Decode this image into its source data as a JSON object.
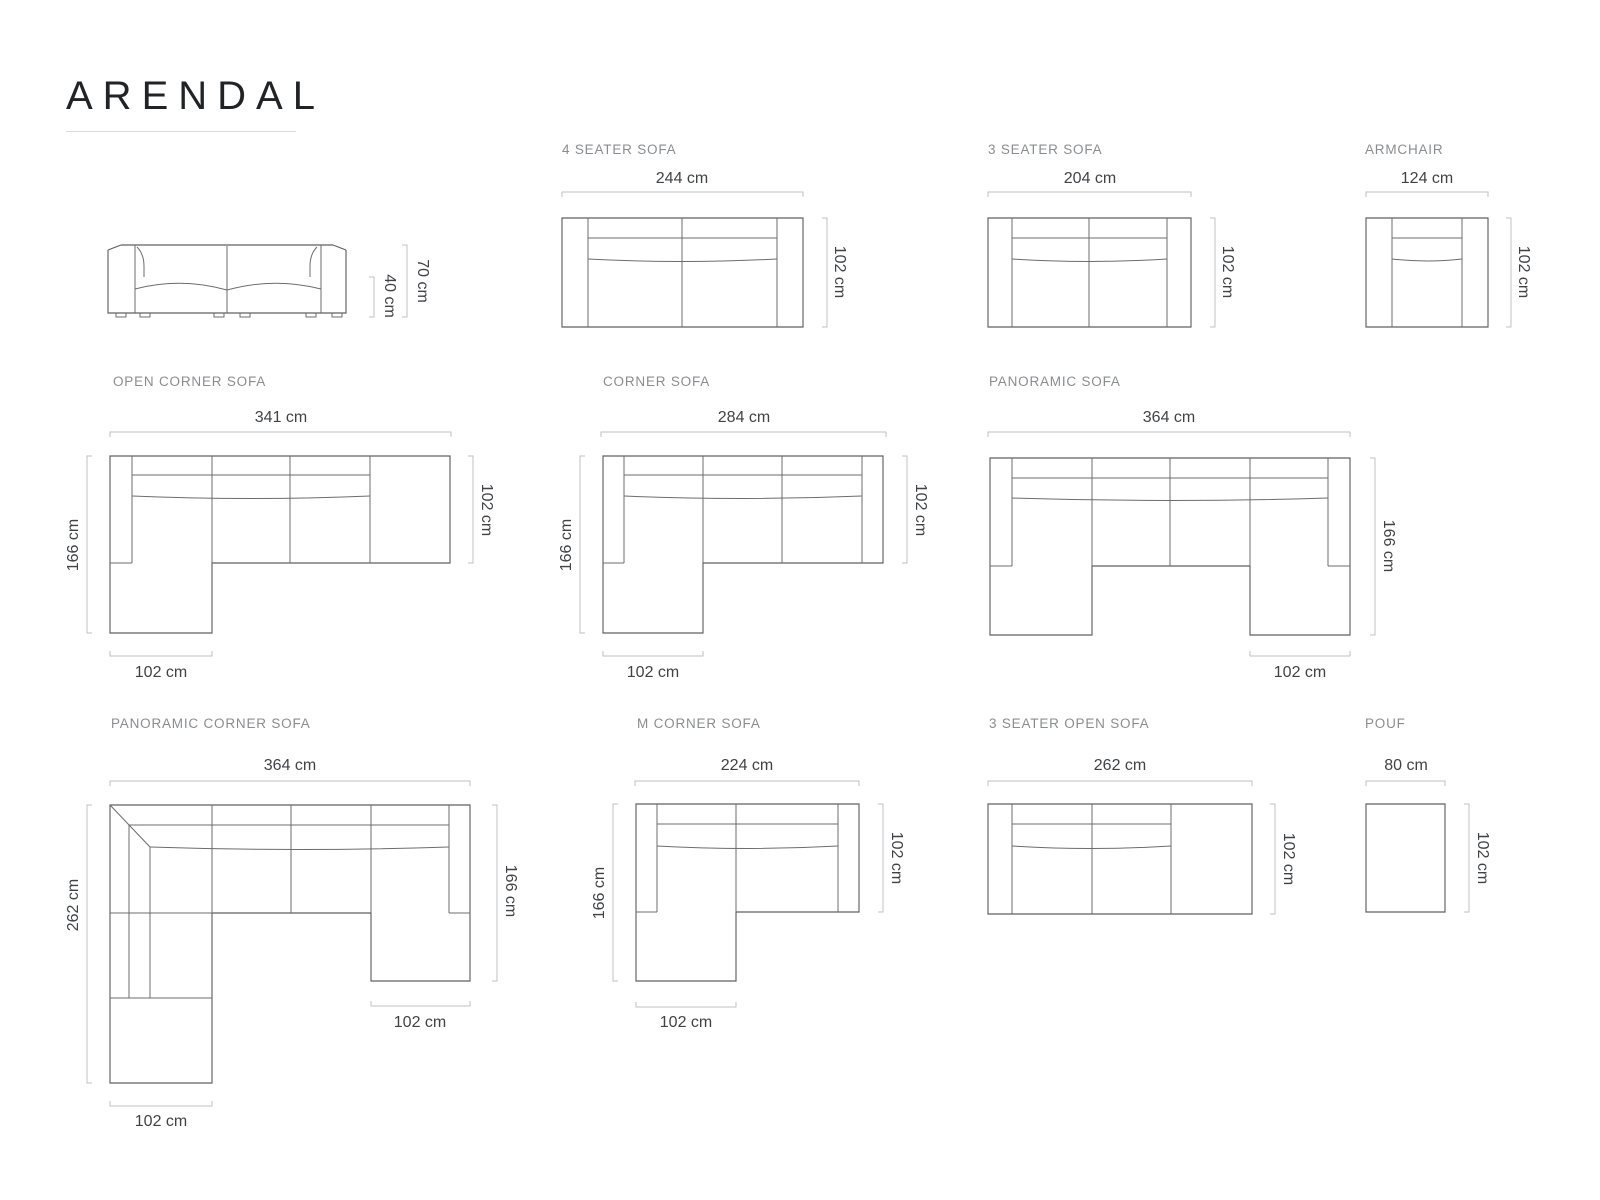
{
  "title": "ARENDAL",
  "colors": {
    "outline": "#5d6063",
    "dimension_line": "#bfc1c3",
    "diagram_label": "#8a8d90",
    "dimension_text": "#404346",
    "title_text": "#212426"
  },
  "diagrams": {
    "side_view": {
      "total_height": "70 cm",
      "seat_height": "40 cm"
    },
    "four_seater": {
      "label": "4 SEATER SOFA",
      "width": "244 cm",
      "depth": "102 cm"
    },
    "three_seater": {
      "label": "3 SEATER SOFA",
      "width": "204 cm",
      "depth": "102 cm"
    },
    "armchair": {
      "label": "ARMCHAIR",
      "width": "124 cm",
      "depth": "102 cm"
    },
    "open_corner": {
      "label": "OPEN CORNER SOFA",
      "width": "341 cm",
      "length": "166 cm",
      "depth": "102 cm",
      "chaise_width": "102 cm"
    },
    "corner": {
      "label": "CORNER SOFA",
      "width": "284 cm",
      "length": "166 cm",
      "depth": "102 cm",
      "chaise_width": "102 cm"
    },
    "panoramic": {
      "label": "PANORAMIC SOFA",
      "width": "364 cm",
      "length": "166 cm",
      "chaise_width": "102 cm"
    },
    "panoramic_corner": {
      "label": "PANORAMIC CORNER SOFA",
      "width": "364 cm",
      "left_length": "262 cm",
      "right_length": "166 cm",
      "chaise_width_right": "102 cm",
      "chaise_width_bottom": "102 cm"
    },
    "m_corner": {
      "label": "M CORNER SOFA",
      "width": "224 cm",
      "length": "166 cm",
      "depth": "102 cm",
      "chaise_width": "102 cm"
    },
    "three_seater_open": {
      "label": "3 SEATER OPEN SOFA",
      "width": "262 cm",
      "depth": "102 cm"
    },
    "pouf": {
      "label": "POUF",
      "width": "80 cm",
      "depth": "102 cm"
    }
  }
}
